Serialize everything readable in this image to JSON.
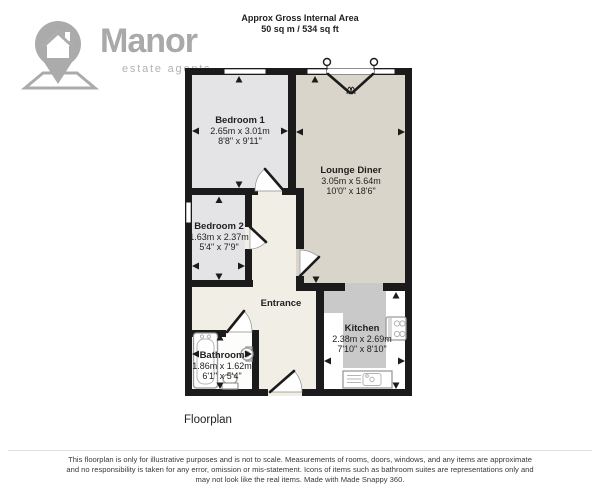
{
  "brand": {
    "name": "Manor",
    "tagline": "estate agents",
    "logo_icon": "map-pin-house-icon"
  },
  "header": {
    "title": "Approx Gross Internal Area",
    "area": "50 sq m / 534 sq ft"
  },
  "floorplan": {
    "caption": "Floorplan",
    "rooms": [
      {
        "id": "bedroom-1",
        "name": "Bedroom 1",
        "metric": "2.65m x 3.01m",
        "imperial": "8'8\" x 9'11\""
      },
      {
        "id": "bedroom-2",
        "name": "Bedroom 2",
        "metric": "1.63m x 2.37m",
        "imperial": "5'4\" x 7'9\""
      },
      {
        "id": "lounge-diner",
        "name": "Lounge Diner",
        "metric": "3.05m x 5.64m",
        "imperial": "10'0\" x 18'6\""
      },
      {
        "id": "entrance",
        "name": "Entrance"
      },
      {
        "id": "kitchen",
        "name": "Kitchen",
        "metric": "2.38m x 2.69m",
        "imperial": "7'10\" x 8'10\""
      },
      {
        "id": "bathroom",
        "name": "Bathroom",
        "metric": "1.86m x 1.62m",
        "imperial": "6'1\" x 5'4\""
      }
    ],
    "fixture_icons": [
      "bathtub-icon",
      "basin-icon",
      "toilet-icon",
      "hob-icon",
      "kitchen-sink-icon",
      "french-doors-icon",
      "measurement-arrow-icon"
    ]
  },
  "footer": {
    "line1": "This floorplan is only for illustrative purposes and is not to scale. Measurements of rooms, doors, windows, and any items are approximate",
    "line2": "and no responsibility is taken for any error, omission or mis-statement. Icons of items such as bathroom suites are representations only and",
    "line3": "may not look like the real items. Made with Made Snappy 360."
  },
  "colors": {
    "wall": "#1b1b1b",
    "bedroom-floor": "#e4e4e6",
    "lounge-floor": "#dad5cb",
    "hall-floor": "#f1eee6",
    "kitchen-floor": "#ffffff",
    "bathroom-floor": "#fdfdfc",
    "counter": "#c9c9c9",
    "brand-gray": "#a9a9a9",
    "text": "#1f1f1f"
  }
}
